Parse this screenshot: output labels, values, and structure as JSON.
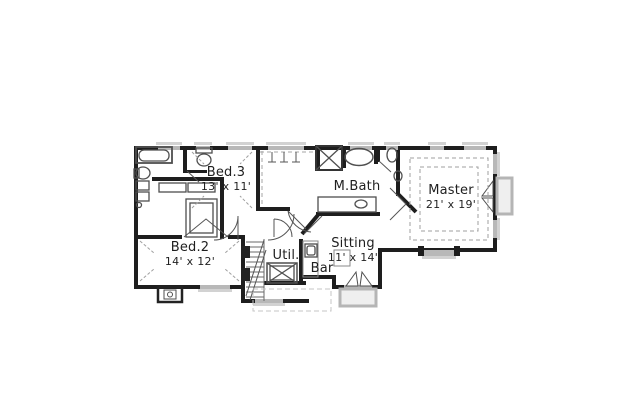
{
  "plan": {
    "type": "floor-plan",
    "colors": {
      "wall": "#1e1e1e",
      "window": "#b8b8b8",
      "sill": "#d2d2d2",
      "fixture_line": "#4f4f4f",
      "dashed_line": "#9f9f9f",
      "bay_fill": "#efefef",
      "background": "#ffffff"
    },
    "rooms": [
      {
        "name": "Bed.3",
        "dims": "13' x 11'"
      },
      {
        "name": "M.Bath"
      },
      {
        "name": "Master",
        "dims": "21' x 19'"
      },
      {
        "name": "Bed.2",
        "dims": "14' x 12'"
      },
      {
        "name": "Util."
      },
      {
        "name": "Bar"
      },
      {
        "name": "Sitting",
        "dims": "11' x 14'"
      }
    ],
    "fixtures": [
      "bathtub",
      "pedestal-sink",
      "toilet",
      "linen-shelves",
      "wardrobe-closet",
      "walk-in-closet-rods",
      "corner-shower",
      "garden-tub",
      "vanity-sink",
      "water-closet",
      "staircase",
      "washer-dryer",
      "bar-sink",
      "chimney",
      "bay-window",
      "tray-ceiling"
    ]
  }
}
